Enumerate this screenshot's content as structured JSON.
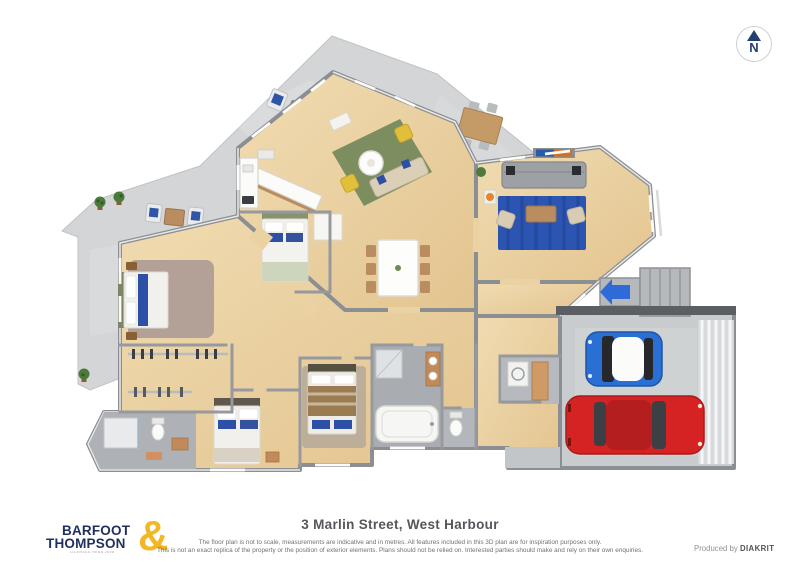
{
  "compass": {
    "label": "N"
  },
  "footer": {
    "logo": {
      "line1": "BARFOOT",
      "line2": "THOMPSON",
      "ampersand": "&",
      "tagline": "LICENSED REAA 2008"
    },
    "address": "3 Marlin Street, West Harbour",
    "disclaimer_line1": "The floor plan is not to scale, measurements are indicative and in metres. All features included in this 3D plan are for inspiration purposes only.",
    "disclaimer_line2": "This is not an exact replica of the property or the position of exterior elements. Plans should not be relied on. Interested parties should make and rely on their own enquiries.",
    "credit_prefix": "Produced by",
    "credit_brand": "DIAKRIT"
  },
  "floorplan": {
    "type": "3d-floor-plan",
    "elements": [
      "north-compass",
      "concrete-patio",
      "outdoor-lounge-set-top",
      "outdoor-lounge-set-left",
      "outdoor-dining-table",
      "living-room-green-rug",
      "living-sofa",
      "yellow-armchairs",
      "round-coffee-table",
      "dining-table-six-chairs",
      "kitchen-counter",
      "family-room-blue-rug",
      "family-gray-sofa",
      "tv-console",
      "master-bedroom",
      "walk-in-wardrobe",
      "ensuite-shower",
      "bedroom-2-blue-bed",
      "bedroom-3-brown-bed",
      "bedroom-4-white-bed",
      "bathroom-tub",
      "toilet",
      "laundry",
      "hallway",
      "entry-stairs",
      "entry-arrow",
      "double-garage",
      "blue-car",
      "red-car",
      "potted-plants"
    ],
    "colors": {
      "wood_floor": "#ead2a3",
      "patio_gray": "#d3d5d7",
      "wall_gray": "#8b8e92",
      "rug_green": "#7c8d60",
      "rug_blue": "#2b55b0",
      "rug_master": "#b3a097",
      "sofa_gray": "#9da0a5",
      "chair_yellow": "#e2bf3a",
      "car_blue": "#2a6fd4",
      "car_red": "#d42322",
      "arrow_blue": "#2f6bd8",
      "brand_navy": "#1f2f5e",
      "brand_yellow": "#f2b722"
    }
  }
}
